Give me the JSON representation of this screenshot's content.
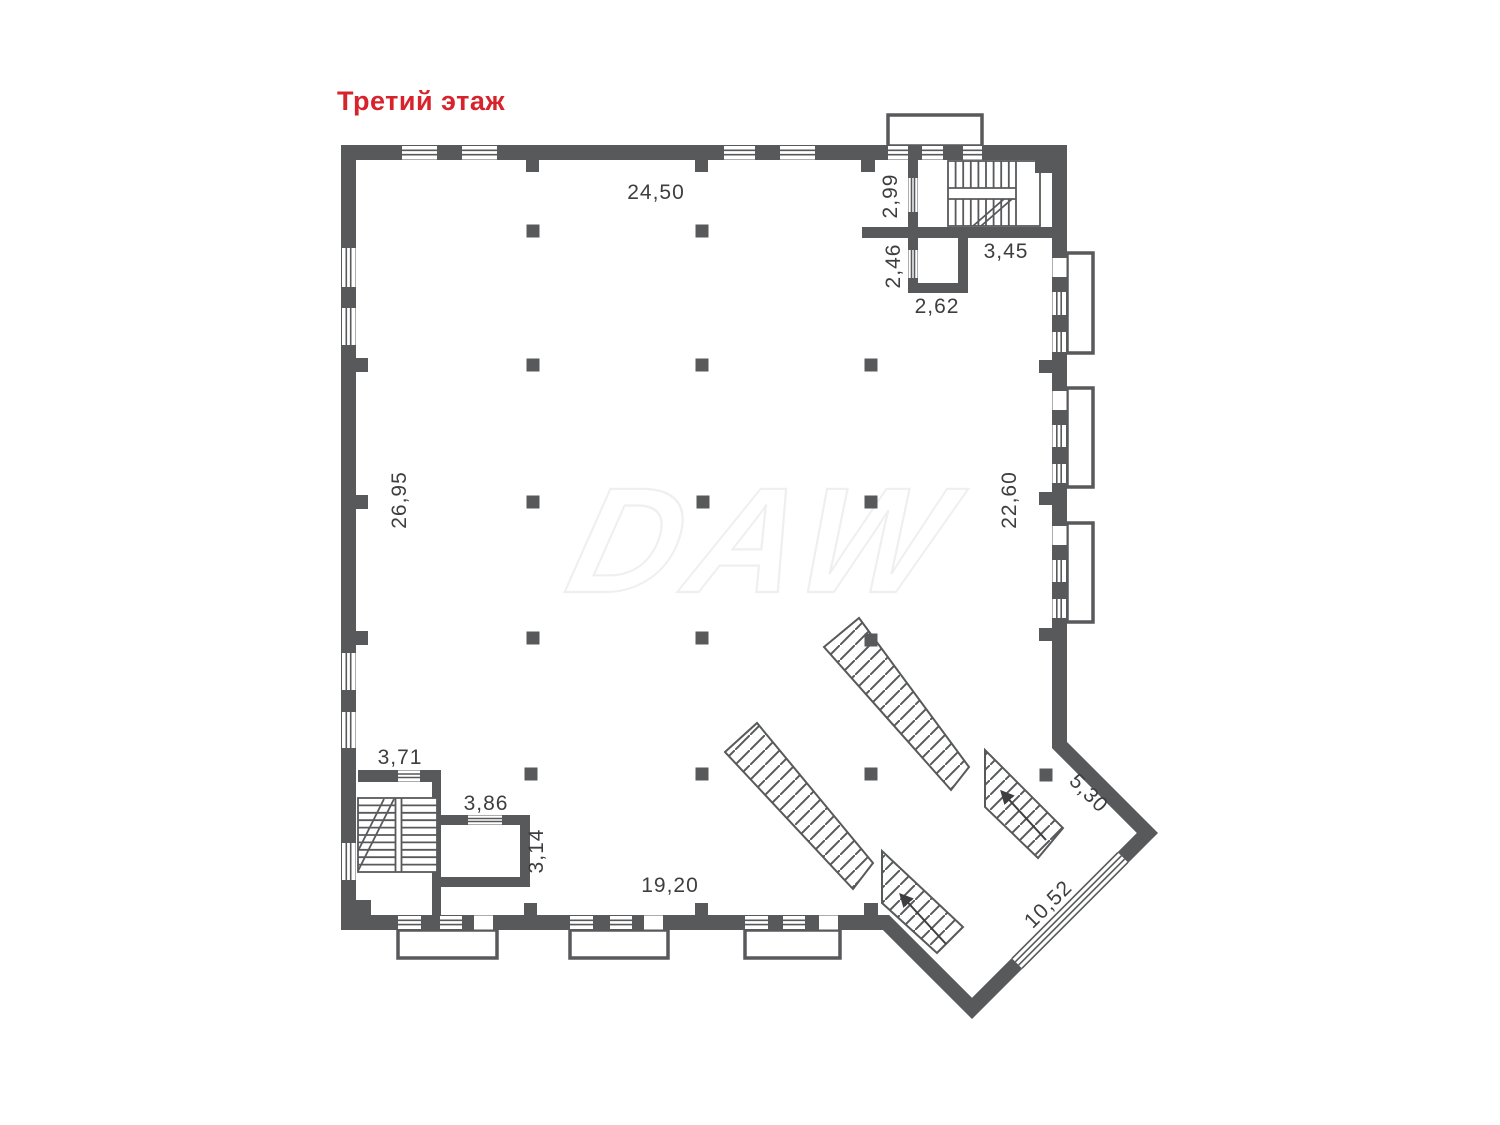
{
  "title": {
    "text": "Третий этаж",
    "color": "#D7232B"
  },
  "watermark": {
    "text": "DAW"
  },
  "colors": {
    "wall": "#58595B",
    "label": "#3E3E40",
    "accent_red": "#D7232B",
    "watermark_stroke": "#F1EEF0"
  },
  "plan": {
    "dimensions": {
      "top_width": "24,50",
      "left_height": "26,95",
      "right_height": "22,60",
      "bottom_width": "19,20",
      "stair_hall_width": "2,99",
      "stair_landing_width": "3,45",
      "shaft_height": "2,46",
      "shaft_width": "2,62",
      "stairwell_width": "3,71",
      "room_width": "3,86",
      "room_height": "3,14",
      "diagonal_wall": "5,30",
      "diagonal_window": "10,52"
    }
  }
}
